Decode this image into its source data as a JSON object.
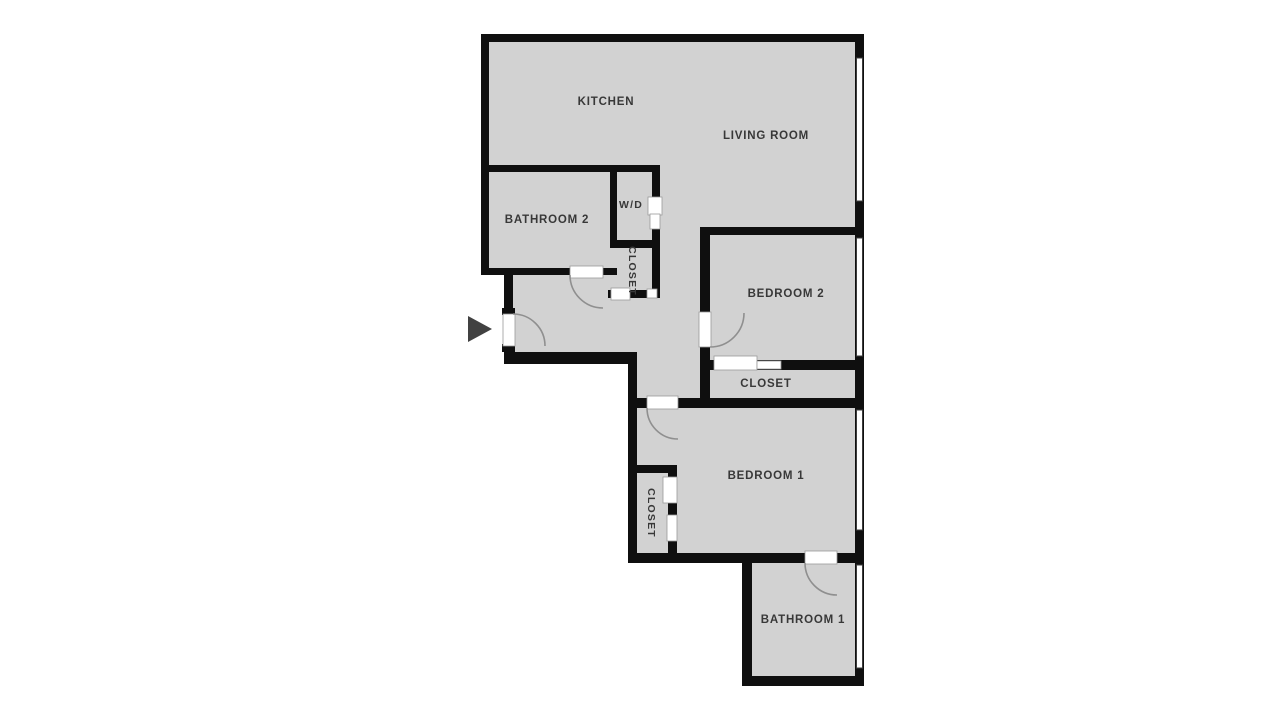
{
  "floorplan": {
    "colors": {
      "background": "#ffffff",
      "floor": "#d2d2d2",
      "wall": "#0f0f0f",
      "window_fill": "#ffffff",
      "window_frame": "#3c3c3c",
      "door_fill": "#ffffff",
      "door_frame": "#9a9a9a",
      "door_arc": "#8f8f8f",
      "label_text": "#383838",
      "entry_arrow": "#414141"
    },
    "labels": {
      "kitchen": "KITCHEN",
      "living_room": "LIVING ROOM",
      "bathroom_2": "BATHROOM 2",
      "washer_dryer": "W/D",
      "closet_hall": "CLOSET",
      "bedroom_2": "BEDROOM 2",
      "closet_bedroom_2": "CLOSET",
      "bedroom_1": "BEDROOM 1",
      "closet_bedroom_1": "CLOSET",
      "bathroom_1": "BATHROOM 1"
    }
  }
}
